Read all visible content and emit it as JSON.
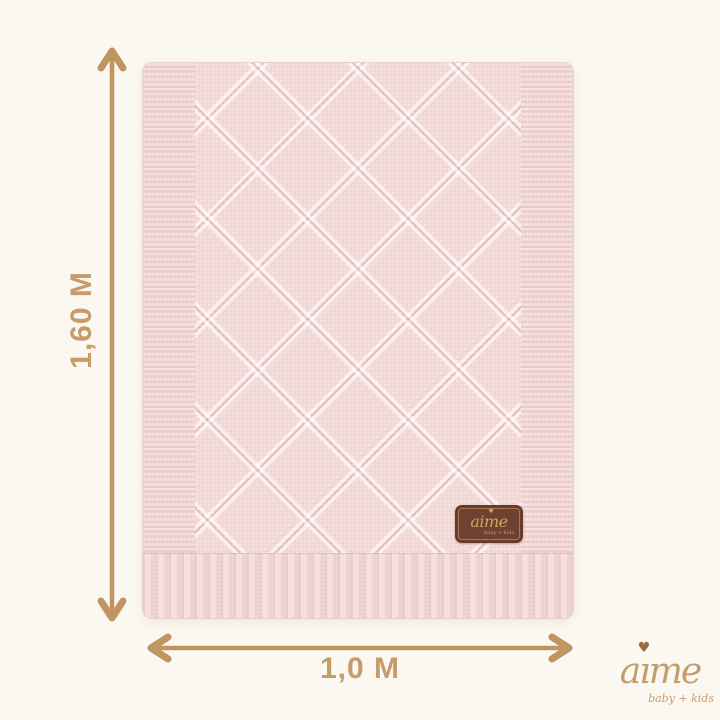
{
  "page": {
    "background_color": "#fbf7f1"
  },
  "dimensions": {
    "height_label": "1,60 M",
    "width_label": "1,0 M",
    "arrow_color": "#bf9562",
    "label_color": "#c59c6a"
  },
  "blanket": {
    "base_color": "#f2d8d5",
    "tag": {
      "brand": "aime",
      "subtext": "baby + kids",
      "heart_icon": "♥",
      "bg_color": "#6e4130",
      "text_color": "#cfa368"
    }
  },
  "logo": {
    "brand_part_a": "a",
    "brand_part_i": "ı",
    "brand_part_me": "me",
    "subtext": "baby + kids",
    "heart_icon": "♥",
    "text_color": "#c59d6d",
    "heart_color": "#9c6847"
  }
}
